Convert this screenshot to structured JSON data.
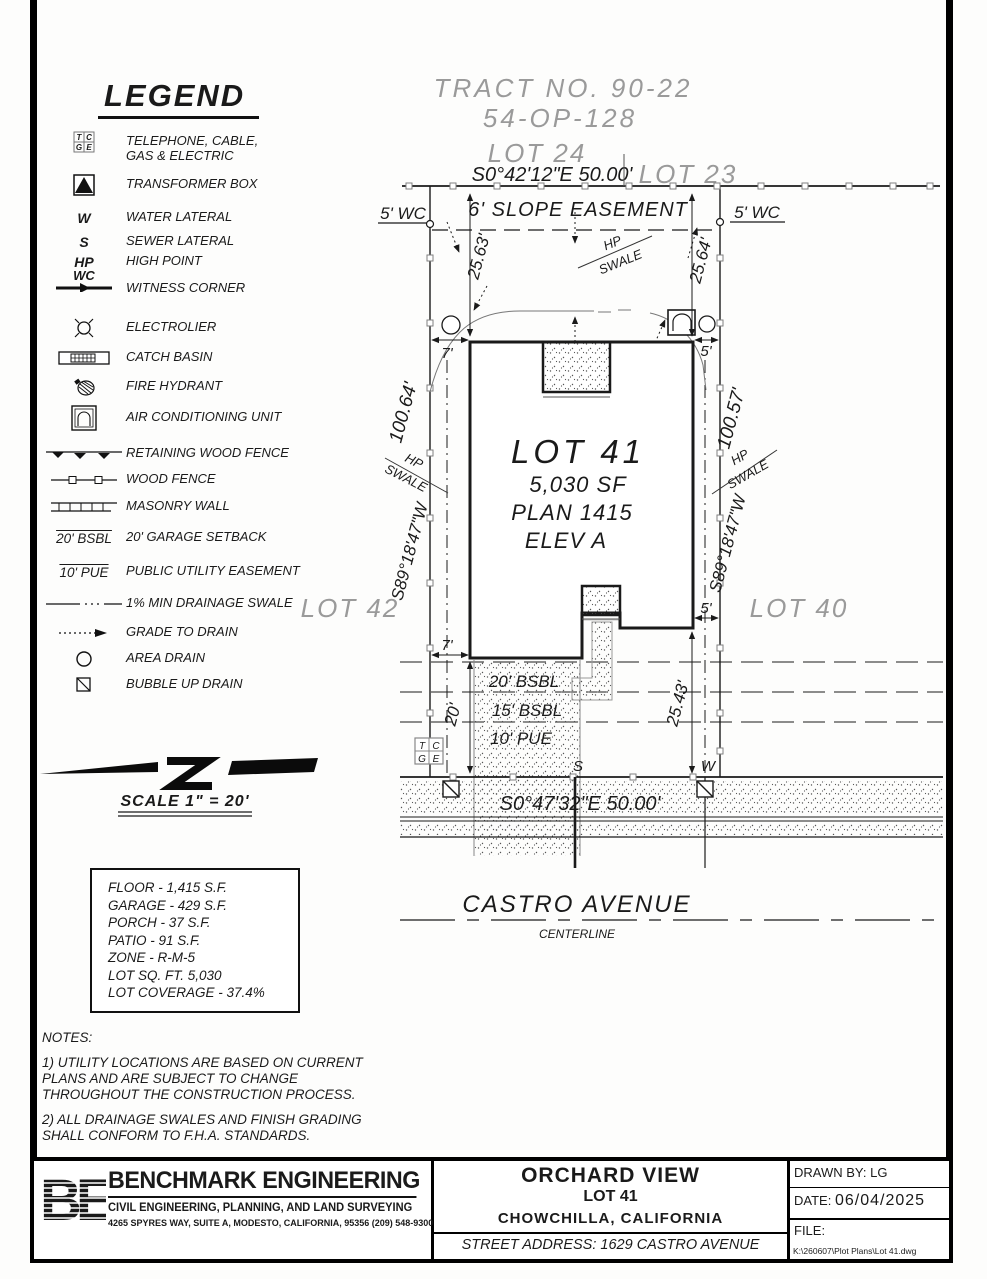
{
  "legend": {
    "title": "LEGEND",
    "items": [
      {
        "name": "telephone-cable-gas-electric",
        "label": "TELEPHONE, CABLE,\nGAS & ELECTRIC"
      },
      {
        "name": "transformer-box",
        "label": "TRANSFORMER BOX"
      },
      {
        "name": "water-lateral",
        "sym": "W",
        "label": "WATER LATERAL"
      },
      {
        "name": "sewer-lateral",
        "sym": "S",
        "label": "SEWER LATERAL"
      },
      {
        "name": "high-point",
        "sym": "HP",
        "label": "HIGH POINT"
      },
      {
        "name": "witness-corner",
        "sym": "WC",
        "label": "WITNESS CORNER"
      },
      {
        "name": "electrolier",
        "label": "ELECTROLIER"
      },
      {
        "name": "catch-basin",
        "label": "CATCH BASIN"
      },
      {
        "name": "fire-hydrant",
        "label": "FIRE HYDRANT"
      },
      {
        "name": "air-conditioning-unit",
        "label": "AIR CONDITIONING UNIT"
      },
      {
        "name": "retaining-wood-fence",
        "label": "RETAINING WOOD FENCE"
      },
      {
        "name": "wood-fence",
        "label": "WOOD FENCE"
      },
      {
        "name": "masonry-wall",
        "label": "MASONRY WALL"
      },
      {
        "name": "garage-setback",
        "sym": "20' BSBL",
        "label": "20' GARAGE SETBACK"
      },
      {
        "name": "public-utility-easement",
        "sym": "10' PUE",
        "label": "PUBLIC UTILITY EASEMENT"
      },
      {
        "name": "drainage-swale",
        "label": "1% MIN DRAINAGE SWALE"
      },
      {
        "name": "grade-to-drain",
        "label": "GRADE TO DRAIN"
      },
      {
        "name": "area-drain",
        "label": "AREA DRAIN"
      },
      {
        "name": "bubble-up-drain",
        "label": "BUBBLE UP DRAIN"
      }
    ]
  },
  "plan": {
    "tract_line1": "TRACT NO. 90-22",
    "tract_line2": "54-OP-128",
    "lot24": "LOT 24",
    "lot23": "LOT 23",
    "lot42": "LOT 42",
    "lot40": "LOT 40",
    "bearing_top": "S0°42'12\"E   50.00'",
    "slope_easement": "6' SLOPE EASEMENT",
    "wc": "5' WC",
    "d2563": "25.63'",
    "d2564": "25.64'",
    "d10064": "100.64'",
    "d10057": "100.57'",
    "bearing_west": "S89°18'47\"W",
    "hp": "HP",
    "swale": "SWALE",
    "d7": "7'",
    "d5": "5'",
    "d20": "20'",
    "d2543": "25.43'",
    "lot_name": "LOT 41",
    "lot_sf": "5,030 SF",
    "lot_plan": "PLAN 1415",
    "lot_elev": "ELEV A",
    "bsbl20": "20' BSBL",
    "bsbl15": "15' BSBL",
    "pue10": "10' PUE",
    "sewer": "S",
    "water": "W",
    "bearing_bottom": "S0°47'32\"E   50.00'",
    "street_name": "CASTRO AVENUE",
    "centerline": "CENTERLINE",
    "tcge": {
      "t": "T",
      "c": "C",
      "g": "G",
      "e": "E"
    }
  },
  "scale": {
    "label": "SCALE  1\" = 20'"
  },
  "stats": {
    "floor": "FLOOR - 1,415 S.F.",
    "garage": "GARAGE - 429 S.F.",
    "porch": "PORCH - 37 S.F.",
    "patio": "PATIO - 91 S.F.",
    "zone": "ZONE - R-M-5",
    "lot_sqft": "LOT SQ. FT. 5,030",
    "coverage": "LOT COVERAGE - 37.4%"
  },
  "notes": {
    "title": "NOTES:",
    "note1": "1) UTILITY LOCATIONS ARE BASED ON CURRENT PLANS AND ARE SUBJECT TO CHANGE THROUGHOUT THE CONSTRUCTION PROCESS.",
    "note2": "2) ALL DRAINAGE SWALES AND FINISH GRADING SHALL CONFORM TO F.H.A. STANDARDS."
  },
  "title_block": {
    "logo_text": "BE",
    "company": "BENCHMARK ENGINEERING",
    "tagline": "CIVIL ENGINEERING, PLANNING, AND LAND SURVEYING",
    "address": "4265 SPYRES WAY, SUITE A, MODESTO, CALIFORNIA, 95356    (209) 548-9300",
    "project": "ORCHARD VIEW",
    "lot": "LOT 41",
    "city": "CHOWCHILLA,    CALIFORNIA",
    "street_address": "STREET   ADDRESS:  1629  CASTRO  AVENUE",
    "drawn_by": "DRAWN  BY:  LG",
    "date_label": "DATE:",
    "date": "06/04/2025",
    "file_label": "FILE:",
    "file_path": "K:\\260607\\Plot Plans\\Lot 41.dwg"
  }
}
